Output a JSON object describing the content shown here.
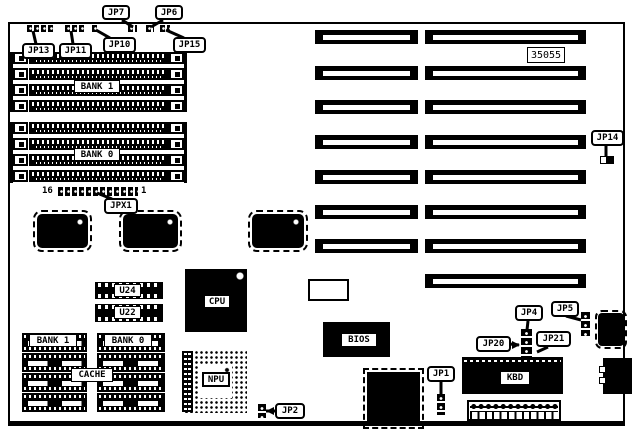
{
  "diagram": {
    "part_number": "35055",
    "callouts": {
      "jp7": "JP7",
      "jp6": "JP6",
      "jp13": "JP13",
      "jp11": "JP11",
      "jp10": "JP10",
      "jp15": "JP15",
      "jpx1": "JPX1",
      "jp14": "JP14",
      "jp2": "JP2",
      "jp4": "JP4",
      "jp5": "JP5",
      "jp20": "JP20",
      "jp21": "JP21",
      "jp1": "JP1"
    },
    "simm": {
      "bank1": "BANK 1",
      "bank0": "BANK 0",
      "jpx1_left_pin": "16",
      "jpx1_right_pin": "1"
    },
    "chips": {
      "cpu": "CPU",
      "npu": "NPU",
      "bios": "BIOS",
      "kbd": "KBD",
      "u24": "U24",
      "u22": "U22"
    },
    "cache": {
      "bank1": "BANK 1",
      "bank0": "BANK 0",
      "label": "CACHE"
    },
    "colors": {
      "ink": "#000000",
      "paper": "#ffffff"
    }
  }
}
